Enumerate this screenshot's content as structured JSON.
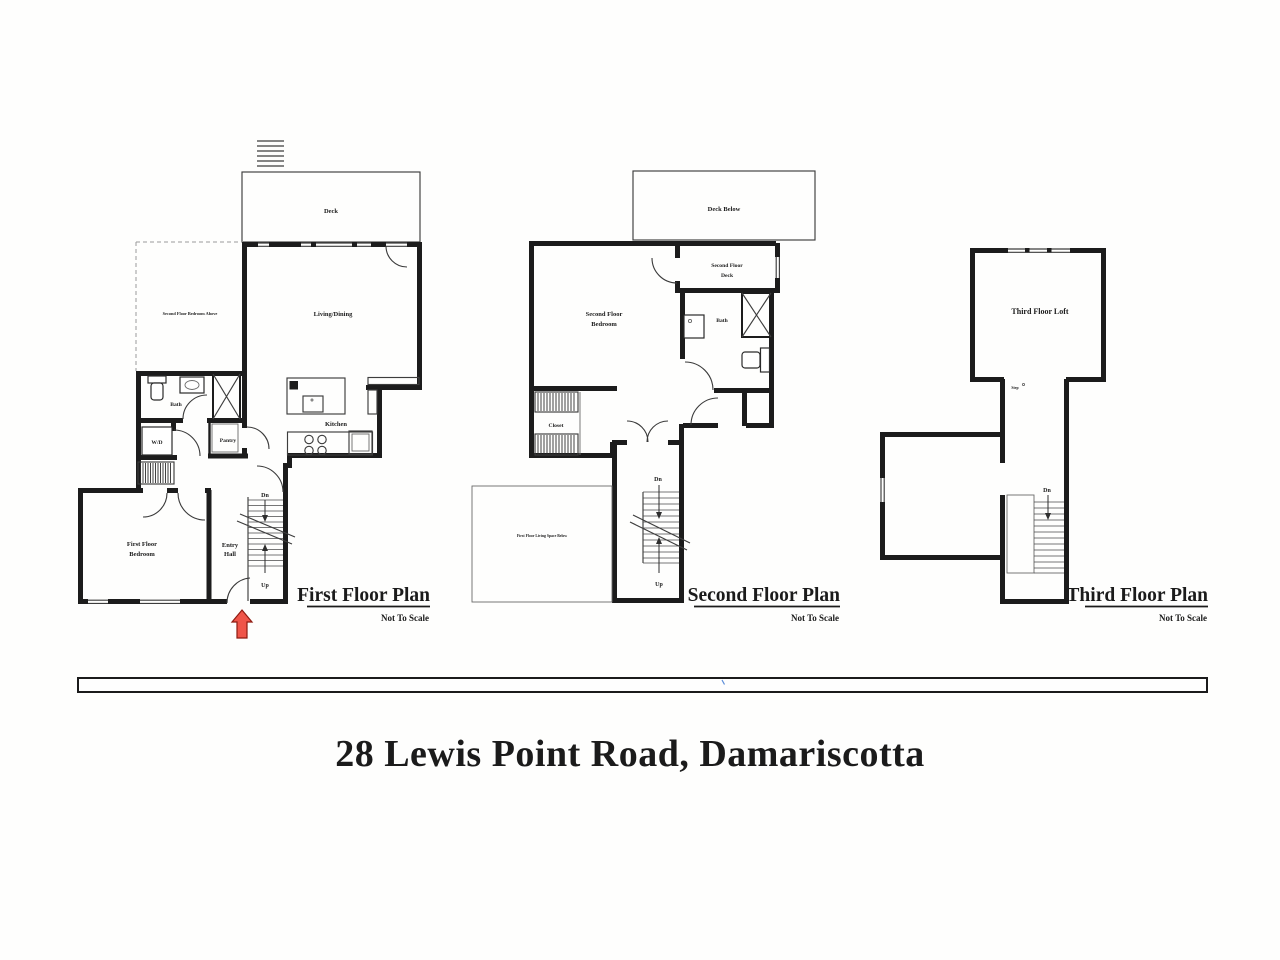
{
  "colors": {
    "wall": "#1c1c1c",
    "arrow_fill": "#ef5549",
    "arrow_stroke": "#8e1a10",
    "address_text": "#9a9a9a"
  },
  "address": "28 Lewis Point Road, Damariscotta",
  "first_floor": {
    "title": "First Floor Plan",
    "scale_note": "Not To Scale",
    "labels": {
      "deck": "Deck",
      "bedroom_above": "Second Floor Bedroom Above",
      "living_dining": "Living/Dining",
      "kitchen": "Kitchen",
      "bath": "Bath",
      "washer_dryer": "W/D",
      "pantry": "Pantry",
      "bedroom_line1": "First Floor",
      "bedroom_line2": "Bedroom",
      "entry_line1": "Entry",
      "entry_line2": "Hall",
      "stairs_down": "Dn",
      "stairs_up": "Up"
    }
  },
  "second_floor": {
    "title": "Second Floor Plan",
    "scale_note": "Not To Scale",
    "labels": {
      "deck_below": "Deck Below",
      "deck_line1": "Second Floor",
      "deck_line2": "Deck",
      "bedroom_line1": "Second Floor",
      "bedroom_line2": "Bedroom",
      "bath": "Bath",
      "closet": "Closet",
      "living_below": "First Floor Living Space Below",
      "stairs_down": "Dn",
      "stairs_up": "Up"
    }
  },
  "third_floor": {
    "title": "Third Floor Plan",
    "scale_note": "Not To Scale",
    "labels": {
      "loft": "Third Floor Loft",
      "step": "Step",
      "stairs_down": "Dn"
    }
  }
}
